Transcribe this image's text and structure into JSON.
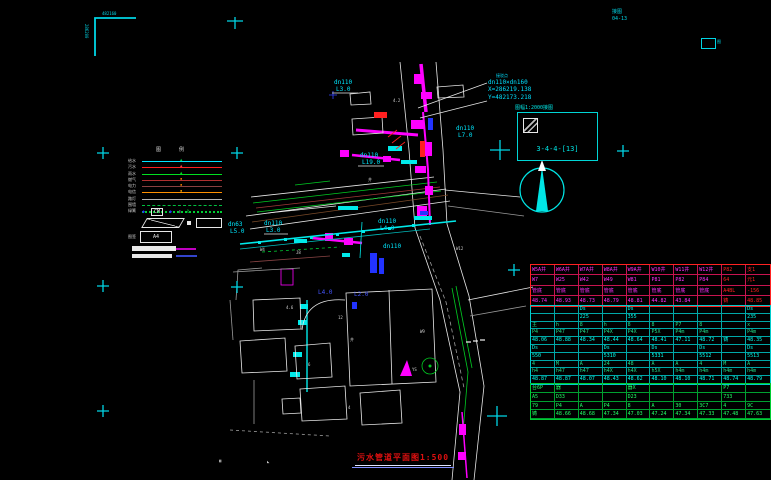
{
  "title": {
    "text": "污水管道平面图1:500"
  },
  "frame": {
    "corner_top": "482160",
    "corner_left": "286200",
    "sheet_label1": "接图",
    "sheet_label2": "04-13",
    "box_label": "图"
  },
  "sheet_index": {
    "label_above": "图幅1:2000接图",
    "figure_label": "3-4-4-[13]"
  },
  "callout": {
    "line0": "接驳点",
    "line1": "dn110×dn160",
    "line2": "X=286219.138",
    "line3": "Y=482173.218"
  },
  "legend": {
    "header": "图例",
    "frame_label": "图签",
    "a4": "A4",
    "symbols": [
      "◆",
      "CM",
      "◆",
      "▮",
      "Ł"
    ],
    "items": [
      {
        "label": "给水",
        "color": "#00e5ff",
        "style": "solid",
        "marker": "▲",
        "marker_color": "#00cc44"
      },
      {
        "label": "污水",
        "color": "#ff2020",
        "style": "solid",
        "marker": "▲",
        "marker_color": "#ff4040"
      },
      {
        "label": "雨水",
        "color": "#00e020",
        "style": "solid",
        "marker": "▲",
        "marker_color": "#00e020"
      },
      {
        "label": "燃气",
        "color": "#b03030",
        "style": "solid",
        "marker": "▪",
        "marker_color": "#ff8800"
      },
      {
        "label": "电力",
        "color": "#8a4040",
        "style": "solid",
        "marker": "▪",
        "marker_color": "#ff8800"
      },
      {
        "label": "电信",
        "color": "#ff9000",
        "style": "solid",
        "marker": "▪",
        "marker_color": "#ffaa00"
      },
      {
        "label": "路灯",
        "color": "#b5b5b5",
        "style": "solid",
        "marker": "",
        "marker_color": "#b5b5b5"
      },
      {
        "label": "围墙",
        "color": "#00c040",
        "style": "dashed",
        "marker": "",
        "marker_color": "#00c040"
      },
      {
        "label": "绿篱",
        "color": "#00cc33",
        "style": "dotted",
        "marker": "",
        "marker_color": "#00cc33"
      }
    ]
  },
  "map": {
    "labels": [
      {
        "t": "dn110",
        "x": 334,
        "y": 80,
        "c": "cy"
      },
      {
        "t": "L3.0",
        "x": 336,
        "y": 87,
        "c": "cy"
      },
      {
        "t": "dn110",
        "x": 456,
        "y": 126,
        "c": "cy"
      },
      {
        "t": "L7.0",
        "x": 458,
        "y": 133,
        "c": "cy"
      },
      {
        "t": "dn110",
        "x": 360,
        "y": 153,
        "c": "cy"
      },
      {
        "t": "L19.0",
        "x": 362,
        "y": 160,
        "c": "cy"
      },
      {
        "t": "dn63",
        "x": 228,
        "y": 222,
        "c": "cy"
      },
      {
        "t": "L5.0",
        "x": 230,
        "y": 229,
        "c": "cy"
      },
      {
        "t": "dn110",
        "x": 264,
        "y": 221,
        "c": "cy"
      },
      {
        "t": "L3.0",
        "x": 266,
        "y": 228,
        "c": "cy"
      },
      {
        "t": "dn110",
        "x": 378,
        "y": 219,
        "c": "cy"
      },
      {
        "t": "L4.0",
        "x": 380,
        "y": 226,
        "c": "cy"
      },
      {
        "t": "dn110",
        "x": 383,
        "y": 244,
        "c": "cy"
      },
      {
        "t": "L4.0",
        "x": 318,
        "y": 290,
        "c": "bl"
      },
      {
        "t": "L2.0",
        "x": 354,
        "y": 292,
        "c": "bl"
      },
      {
        "t": "W9",
        "x": 420,
        "y": 330,
        "c": "wh"
      },
      {
        "t": "4.2",
        "x": 393,
        "y": 99,
        "c": "wh"
      },
      {
        "t": "井",
        "x": 368,
        "y": 178,
        "c": "wh"
      },
      {
        "t": "4.6",
        "x": 286,
        "y": 306,
        "c": "wh"
      },
      {
        "t": "12",
        "x": 338,
        "y": 316,
        "c": "wh"
      },
      {
        "t": "W4",
        "x": 260,
        "y": 248,
        "c": "wh"
      },
      {
        "t": "井",
        "x": 350,
        "y": 338,
        "c": "wh"
      },
      {
        "t": "W12",
        "x": 456,
        "y": 247,
        "c": "wh"
      },
      {
        "t": "6",
        "x": 308,
        "y": 363,
        "c": "wh"
      },
      {
        "t": "4",
        "x": 348,
        "y": 406,
        "c": "wh"
      },
      {
        "t": "YS",
        "x": 412,
        "y": 368,
        "c": "wh"
      },
      {
        "t": "J8",
        "x": 296,
        "y": 251,
        "c": "wh"
      },
      {
        "t": "▦",
        "x": 219,
        "y": 459,
        "c": "wh"
      },
      {
        "t": "◣",
        "x": 267,
        "y": 460,
        "c": "wh"
      }
    ]
  },
  "table": {
    "sections": [
      {
        "top": 0,
        "h": 41,
        "border": "#ff2222",
        "grid": "#c81450",
        "red_cols": [
          8,
          9
        ],
        "red_color": "#ff2020",
        "rows": [
          {
            "color": "#ff30ff",
            "cells": [
              "W5A井",
              "W6A井",
              "W7A井",
              "W8A井",
              "W9A井",
              "W10井",
              "W11井",
              "W12井",
              "P82",
              "支1"
            ]
          },
          {
            "color": "#ff30ff",
            "cells": [
              "W7",
              "W25",
              "W42",
              "W49",
              "W81",
              "P81",
              "P82",
              "P84",
              "64",
              "元1"
            ]
          },
          {
            "color": "#ff30ff",
            "cells": [
              "管底",
              "管底",
              "管底",
              "管底",
              "管底",
              "管底",
              "管底",
              "管底",
              "A4BL",
              "-156"
            ]
          },
          {
            "color": "#ff30ff",
            "cells": [
              "48.74",
              "48.93",
              "48.73",
              "48.79",
              "48.81",
              "44.82",
              "43.84",
              "",
              "铸",
              "48.85"
            ]
          }
        ]
      },
      {
        "top": 41,
        "h": 78,
        "border": "#00cccc",
        "grid": "#00a8a8",
        "red_cols": [],
        "red_color": "#ff2020",
        "rows": [
          {
            "color": "#00ffee",
            "cells": [
              "",
              "",
              "Ds",
              "",
              "Ds",
              "",
              "",
              "",
              "",
              "Ds"
            ]
          },
          {
            "color": "#00ffee",
            "cells": [
              "",
              "",
              "225",
              "",
              "355",
              "",
              "",
              "",
              "",
              "235"
            ]
          },
          {
            "color": "#22dd88",
            "cells": [
              "主",
              "h",
              "8",
              "h",
              "8",
              "8",
              "P7",
              "8",
              "",
              "x"
            ]
          },
          {
            "color": "#22dd88",
            "cells": [
              "P4",
              "P47",
              "P47",
              "P4X",
              "P4X",
              "P5X",
              "P4m",
              "P4m",
              "",
              "P4m"
            ]
          },
          {
            "color": "#00ffee",
            "cells": [
              "48.06",
              "48.88",
              "48.34",
              "48.44",
              "48.64",
              "48.41",
              "47.11",
              "48.72",
              "铸",
              "48.35"
            ]
          },
          {
            "color": "#00ffee",
            "cells": [
              "Ds",
              "",
              "",
              "Ds",
              "",
              "Ds",
              "",
              "Ds",
              "",
              "Ds"
            ]
          },
          {
            "color": "#00ffee",
            "cells": [
              "550",
              "",
              "",
              "5310",
              "",
              "5331",
              "",
              "5512",
              "",
              "5513"
            ]
          },
          {
            "color": "#22dd88",
            "cells": [
              "4",
              "M",
              "A",
              "24",
              "48",
              "A",
              "A",
              "4",
              "M",
              "A"
            ]
          },
          {
            "color": "#22dd88",
            "cells": [
              "h4",
              "h47",
              "h47",
              "h4X",
              "h4X",
              "h5X",
              "h4m",
              "h4m",
              "h4m",
              "h4m"
            ]
          },
          {
            "color": "#00ffee",
            "cells": [
              "48.87",
              "48.87",
              "48.07",
              "48.43",
              "48.62",
              "48.10",
              "48.10",
              "48.71",
              "48.74",
              "48.79"
            ]
          }
        ]
      },
      {
        "top": 119,
        "h": 35,
        "border": "#00cc33",
        "grid": "#00a030",
        "red_cols": [],
        "red_color": "#ff2020",
        "rows": [
          {
            "color": "#22ff66",
            "cells": [
              "台6P",
              "器",
              "",
              "",
              "器X",
              "",
              "",
              "",
              "P7",
              ""
            ]
          },
          {
            "color": "#22ff66",
            "cells": [
              "A5",
              "D33",
              "",
              "",
              "D23",
              "",
              "",
              "",
              "733",
              ""
            ]
          },
          {
            "color": "#22ff66",
            "cells": [
              "79",
              "P4",
              "A",
              "P4",
              "8",
              "A",
              "30",
              "3C7",
              "4",
              "9C"
            ]
          },
          {
            "color": "#22ff66",
            "cells": [
              "铸",
              "48.66",
              "48.68",
              "47.34",
              "47.03",
              "47.24",
              "47.34",
              "47.33",
              "47.48",
              "47.63"
            ]
          }
        ]
      }
    ]
  },
  "colors": {
    "pipe_magenta": "#ff00ff",
    "pipe_cyan": "#00eaea",
    "road_green": "#00cc22",
    "alert_red": "#ff2020",
    "frame_cyan": "#00d5e5"
  }
}
